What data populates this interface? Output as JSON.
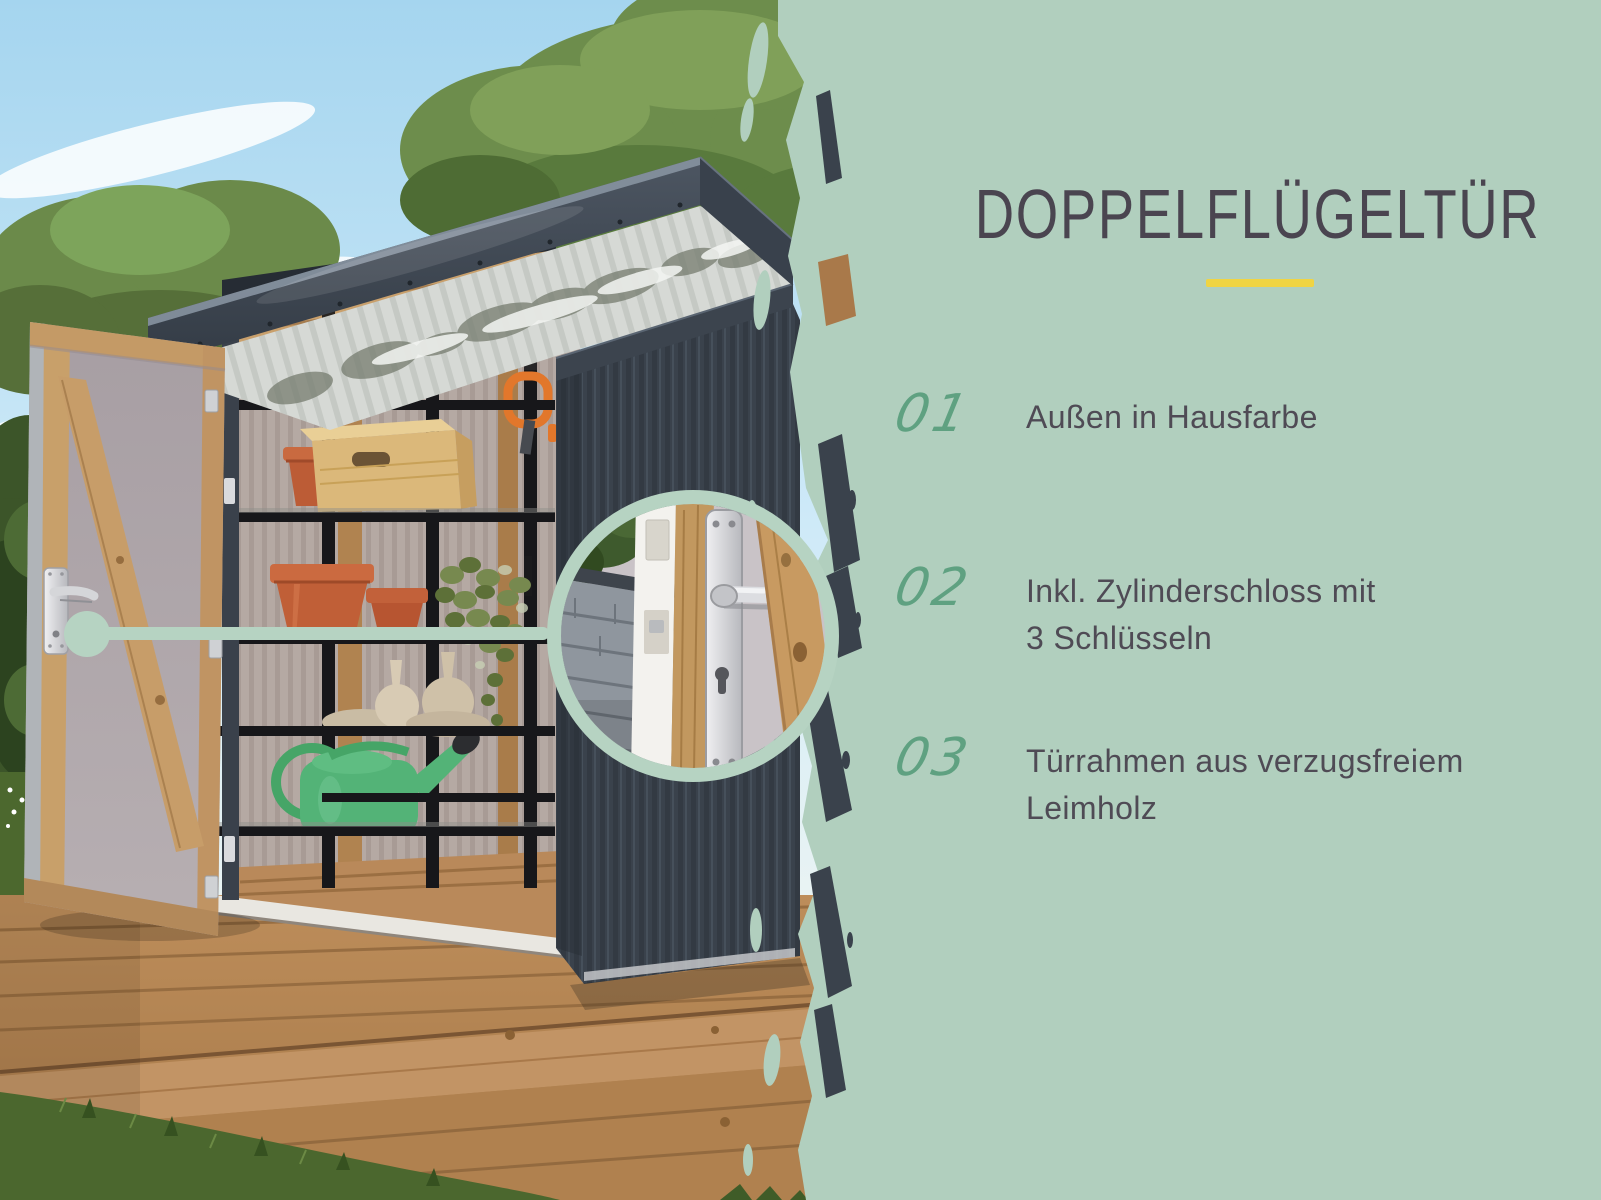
{
  "panel": {
    "title": "DOPPELFLÜGELTÜR",
    "features": [
      {
        "number": "01",
        "lines": [
          "Außen in Hausfarbe",
          ""
        ]
      },
      {
        "number": "02",
        "lines": [
          "Inkl. Zylinderschloss mit",
          "3 Schlüsseln"
        ]
      },
      {
        "number": "03",
        "lines": [
          "Türrahmen aus verzugsfreiem",
          "Leimholz"
        ]
      }
    ]
  },
  "colors": {
    "panel_green": "#b1cfbe",
    "accent_yellow": "#f0d443",
    "number_green": "#5fa181",
    "title_color": "#4a4550",
    "text_color": "#4f4b55",
    "callout_ring": "#b6d3c2"
  }
}
